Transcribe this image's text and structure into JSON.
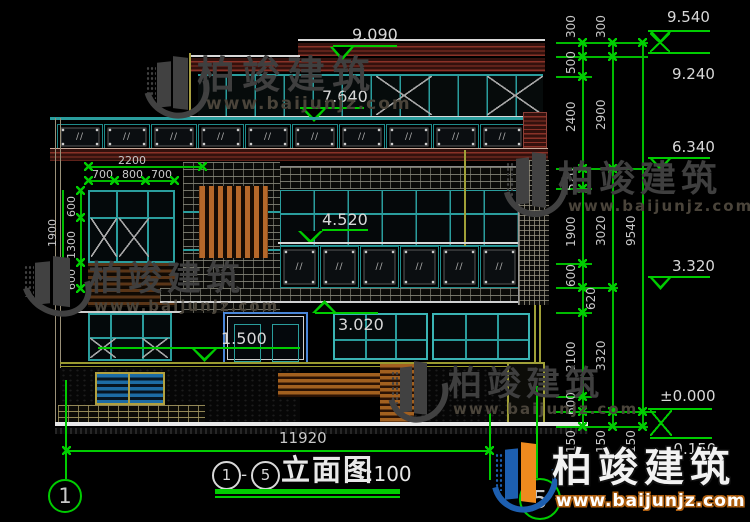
{
  "drawing": {
    "title_circle_start": "1",
    "title_separator": "-",
    "title_circle_end": "5",
    "title_name": "立面图",
    "title_scale": "1:100",
    "overall_width_dim": "11920",
    "grid_bubble_left": "1",
    "grid_bubble_right": "5"
  },
  "watermark": {
    "company": "柏竣建筑",
    "website": "www.baijunjz.com"
  },
  "elevations": {
    "v9540": "9.540",
    "v9240": "9.240",
    "v9090": "9.090",
    "v7640": "7.640",
    "v6340": "6.340",
    "v4520": "4.520",
    "v3320": "3.320",
    "v3020": "3.020",
    "v1500": "1.500",
    "v0": "±0.000",
    "vneg150": "-0.150"
  },
  "right_dims": {
    "chain1": [
      "300",
      "500",
      "2400",
      "520",
      "1900",
      "600",
      "620",
      "2100",
      "600",
      "150"
    ],
    "chain2": [
      "300",
      "2900",
      "3020",
      "3320",
      "150"
    ],
    "chain3": [
      "9540",
      "150"
    ]
  },
  "left_dims": {
    "width_total": "2200",
    "widths": [
      "700",
      "800",
      "700"
    ],
    "height_total": "1900",
    "heights": [
      "600",
      "1300",
      "600"
    ]
  },
  "glass_hatch": "∕∕",
  "colors": {
    "background": "#000000",
    "dim_green": "#00cc00",
    "frame_teal": "#2a9d9d",
    "slab_maroon": "#8a3228",
    "wood_orange": "#b5682a",
    "cad_text": "#c8c8c8",
    "logo_blue": "#1d5fb0",
    "logo_orange": "#ee8a1e"
  }
}
